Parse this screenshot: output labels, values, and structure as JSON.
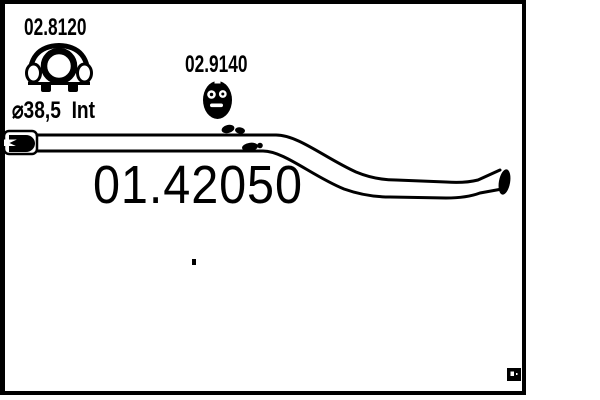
{
  "colors": {
    "ink": "#000000",
    "paper": "#ffffff"
  },
  "diagram": {
    "clamp_a": {
      "part_number": "02.8120",
      "size": "43",
      "icon": "strap-clamp-icon"
    },
    "clamp_b": {
      "part_number": "02.9140",
      "icon": "band-clamp-icon"
    },
    "inlet": {
      "diameter_label": "⌀38,5  Int"
    },
    "main_part_number": "01.42050"
  }
}
